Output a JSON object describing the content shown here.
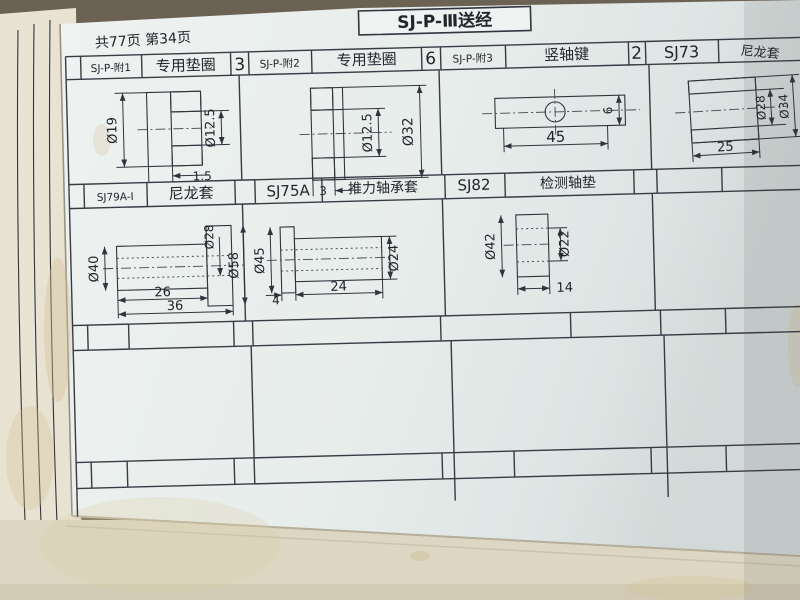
{
  "page": {
    "title": "SJ-P-Ⅲ送经",
    "page_info": "共77页 第34页"
  },
  "row1": {
    "parts": [
      {
        "id": "SJ-P-附1",
        "name": "专用垫圈",
        "qty": "3"
      },
      {
        "id": "SJ-P-附2",
        "name": "专用垫圈",
        "qty": "6"
      },
      {
        "id": "SJ-P-附3",
        "name": "竖轴键",
        "qty": "2"
      },
      {
        "id": "SJ73",
        "name": "尼龙套"
      }
    ]
  },
  "row2": {
    "parts": [
      {
        "id": "SJ79A-Ⅰ",
        "name": "尼龙套"
      },
      {
        "id": "SJ75A",
        "name": "推力轴承套"
      },
      {
        "id": "SJ82",
        "name": "检测轴垫"
      }
    ]
  },
  "dims": {
    "washer1": {
      "outer": "Ø19",
      "inner": "Ø12.5",
      "thickness": "1.5"
    },
    "washer2": {
      "inner": "Ø12.5",
      "outer": "Ø32",
      "thickness": "3"
    },
    "key": {
      "length": "45",
      "height": "6"
    },
    "nylon_sj73": {
      "bore": "Ø28",
      "outer": "Ø34",
      "length": "25"
    },
    "nylon_sj79a": {
      "body": "Ø40",
      "bore": "Ø28",
      "flange": "Ø58",
      "body_len": "26",
      "total_len": "36"
    },
    "thrust_sleeve": {
      "flange": "Ø45",
      "body": "Ø24",
      "flange_w": "4",
      "body_len": "24"
    },
    "washer_sj82": {
      "outer": "Ø42",
      "bore": "Ø22",
      "length": "14"
    }
  }
}
